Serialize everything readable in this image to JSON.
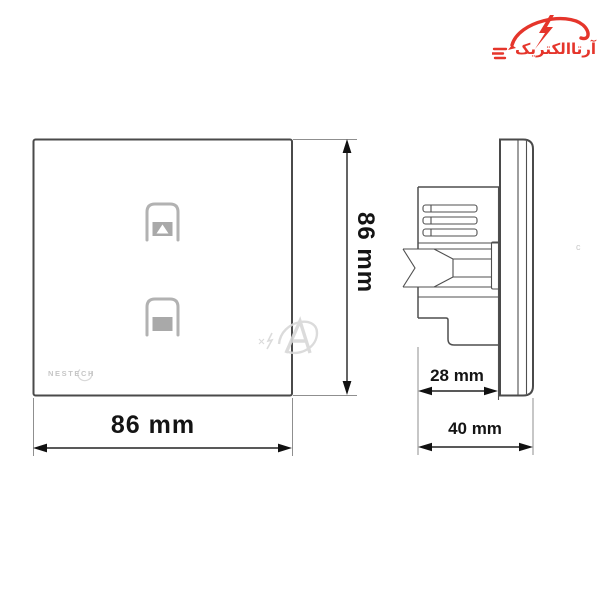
{
  "colors": {
    "accent_red": "#e5352b",
    "line": "#4f4f4f",
    "dim": "#141414",
    "icon_gray": "#b2b2b2",
    "icon_fill": "#a9a9a9",
    "brand_gray": "#c6c6c6",
    "wm_gray": "#d8d8d8"
  },
  "brand_logo": {
    "text": "آرتاالکتریک",
    "color": "#e5352b",
    "icon": "lightning-swoosh-icon"
  },
  "front_view": {
    "brand": "NESTECH",
    "height_label": "86 mm",
    "width_label": "86 mm",
    "buttons": [
      {
        "icon": "curtain-open-icon"
      },
      {
        "icon": "curtain-close-icon"
      }
    ]
  },
  "side_view": {
    "body_depth_label": "28 mm",
    "total_depth_label": "40 mm"
  },
  "watermark": {
    "mark": "c",
    "icon": "arta-watermark-logo"
  }
}
